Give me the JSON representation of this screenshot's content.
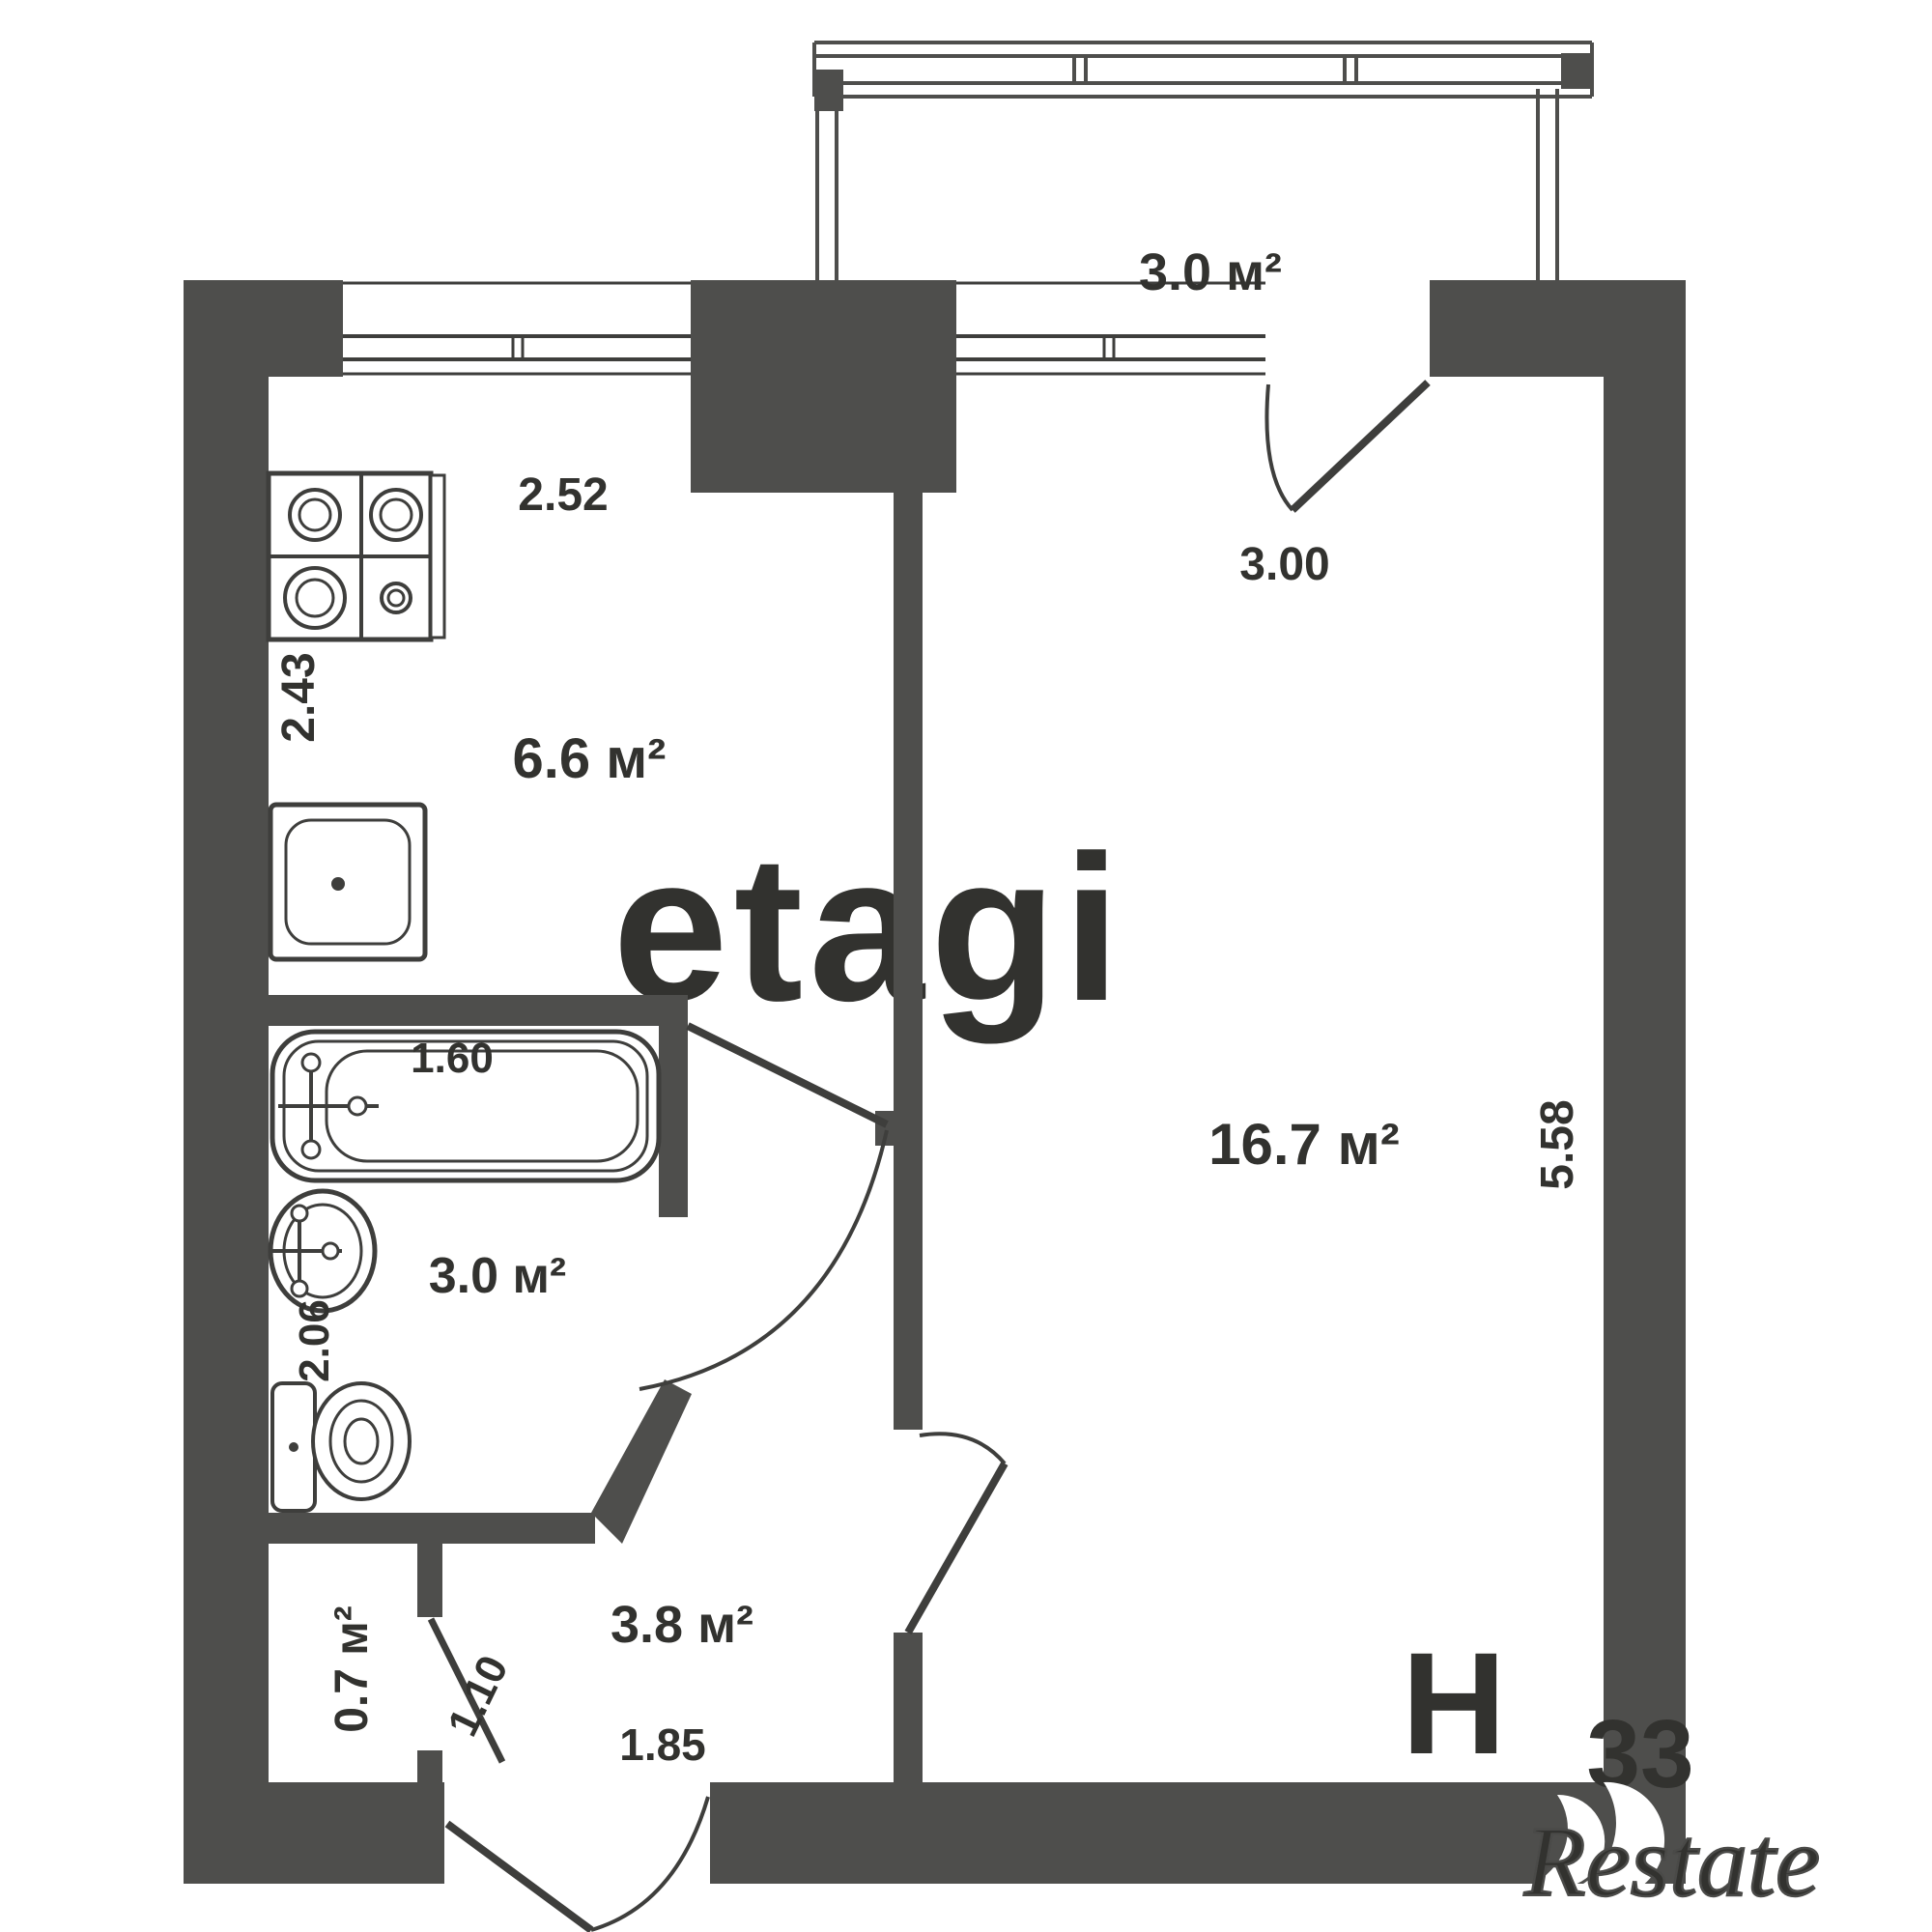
{
  "watermarks": {
    "brand_center": "etagi",
    "corner_letter": "Н",
    "corner_number": "33",
    "logo_bottom_right": "Restate"
  },
  "rooms": {
    "balcony": {
      "area": "3.0 м²"
    },
    "kitchen": {
      "area": "6.6 м²",
      "width": "2.52",
      "depth": "2.43"
    },
    "living_room": {
      "area": "16.7 м²",
      "width": "3.00",
      "depth": "5.58"
    },
    "bathroom": {
      "area": "3.0 м²",
      "bathtub_length": "1.60",
      "depth": "2.06"
    },
    "closet": {
      "area": "0.7 м²",
      "door_width": "1.10"
    },
    "hallway": {
      "area": "3.8 м²",
      "width": "1.85"
    }
  }
}
